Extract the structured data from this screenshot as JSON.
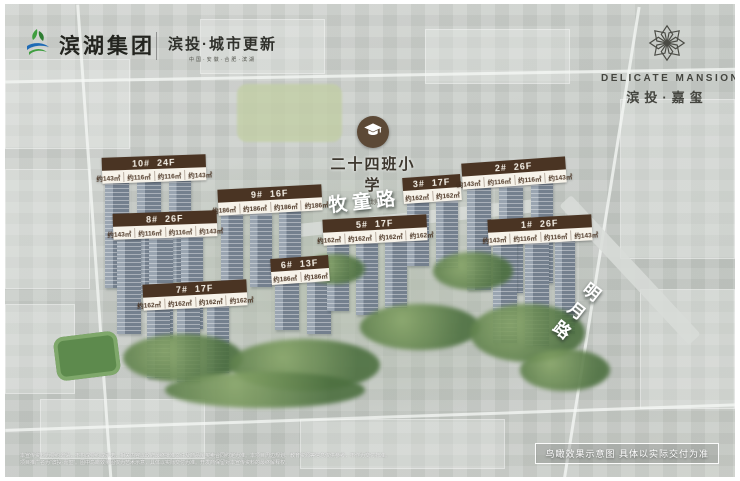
{
  "header": {
    "binhu_group": {
      "name": "滨湖集团"
    },
    "bintou_urban": {
      "name": "滨投·城市更新",
      "subtitle": "中国·安徽·合肥·滨湖"
    },
    "delicate_mansion": {
      "en": "DELICATE MANSION",
      "cn": "滨投·嘉玺"
    }
  },
  "school": {
    "name": "二十四班小学",
    "note": "(规划中)"
  },
  "roads": {
    "mutong": "牧童路",
    "mingyue": "明月路"
  },
  "buildings": [
    {
      "id": "10#",
      "floors": "24F",
      "units": [
        "约143㎡",
        "约116㎡",
        "约116㎡",
        "约143㎡"
      ]
    },
    {
      "id": "9#",
      "floors": "16F",
      "units": [
        "约186㎡",
        "约186㎡",
        "约186㎡",
        "约186㎡"
      ]
    },
    {
      "id": "8#",
      "floors": "26F",
      "units": [
        "约143㎡",
        "约116㎡",
        "约116㎡",
        "约143㎡"
      ]
    },
    {
      "id": "7#",
      "floors": "17F",
      "units": [
        "约162㎡",
        "约162㎡",
        "约162㎡",
        "约162㎡"
      ]
    },
    {
      "id": "6#",
      "floors": "13F",
      "units": [
        "约186㎡",
        "约186㎡"
      ]
    },
    {
      "id": "5#",
      "floors": "17F",
      "units": [
        "约162㎡",
        "约162㎡",
        "约162㎡",
        "约162㎡"
      ]
    },
    {
      "id": "3#",
      "floors": "17F",
      "units": [
        "约162㎡",
        "约162㎡"
      ]
    },
    {
      "id": "2#",
      "floors": "26F",
      "units": [
        "约143㎡",
        "约116㎡",
        "约116㎡",
        "约143㎡"
      ]
    },
    {
      "id": "1#",
      "floors": "26F",
      "units": [
        "约143㎡",
        "约116㎡",
        "约116㎡",
        "约143㎡"
      ]
    }
  ],
  "footer": {
    "note_box": "鸟瞰效果示意图  具体以实际交付为准",
    "fine_print_1": "本宣传资料为要约邀请，不构成要约或承诺，相关内容以政府最终批准文件及商品房买卖合同约定为准。本项目周边规划、教育资源等信息仅供参考，不作为交付标准。",
    "fine_print_2": "项目推广名为“滨投·嘉玺”。图中鸟瞰效果图仅为艺术示意，具体以实际交付为准。开发商保留对本宣传资料的最终解释权。"
  },
  "colors": {
    "label_brown": "#4a3423",
    "label_cream": "#f7f3ea",
    "school_brown": "#5c4936",
    "logo_charcoal": "#44453f"
  }
}
